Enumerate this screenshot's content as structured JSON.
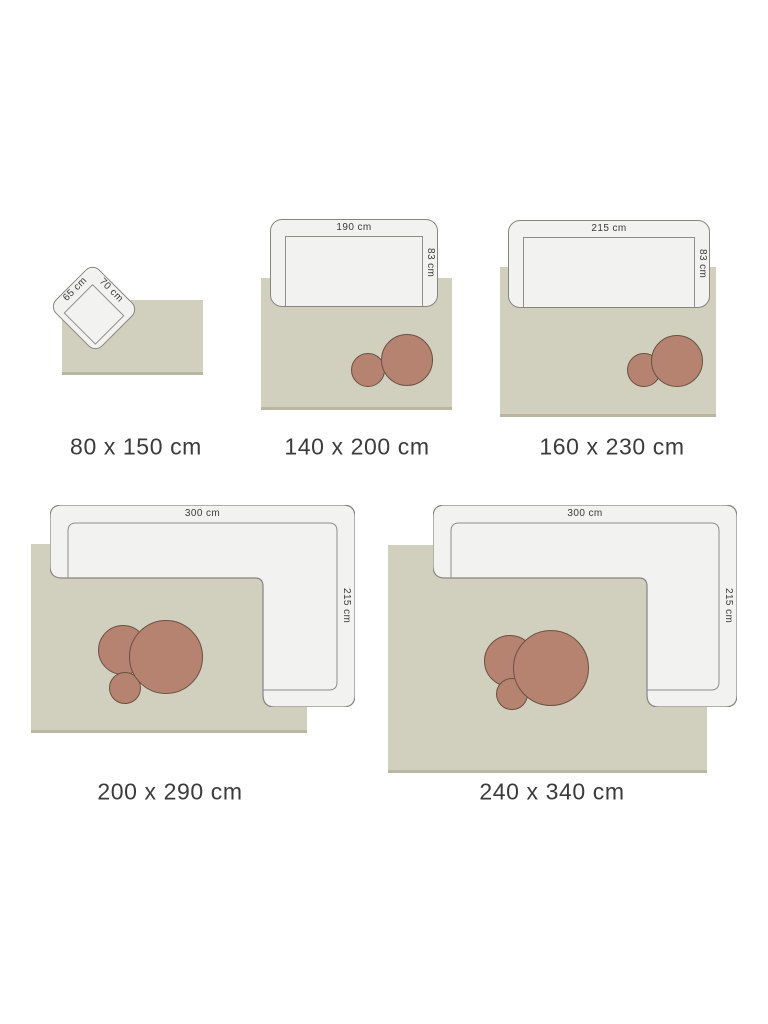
{
  "colors": {
    "rug": "#d1cfbd",
    "rug_shadow": "#b9b7a4",
    "sofa_fill": "#f2f2f0",
    "sofa_border": "#86867f",
    "seat_line": "#8f8f88",
    "table_fill": "#b5836f",
    "table_border": "#6b5143",
    "text": "#3b3b3b",
    "page_bg": "#ffffff"
  },
  "panels": [
    {
      "size_label": "80 x 150 cm",
      "furniture": {
        "type": "armchair",
        "width_label": "65 cm",
        "depth_label": "70 cm"
      }
    },
    {
      "size_label": "140 x 200 cm",
      "furniture": {
        "type": "sofa",
        "width_label": "190 cm",
        "depth_label": "83 cm"
      }
    },
    {
      "size_label": "160 x 230 cm",
      "furniture": {
        "type": "sofa",
        "width_label": "215 cm",
        "depth_label": "83 cm"
      }
    },
    {
      "size_label": "200 x 290 cm",
      "furniture": {
        "type": "corner-sofa",
        "width_label": "300 cm",
        "depth_label": "215 cm"
      }
    },
    {
      "size_label": "240 x 340 cm",
      "furniture": {
        "type": "corner-sofa",
        "width_label": "300 cm",
        "depth_label": "215 cm"
      }
    }
  ]
}
